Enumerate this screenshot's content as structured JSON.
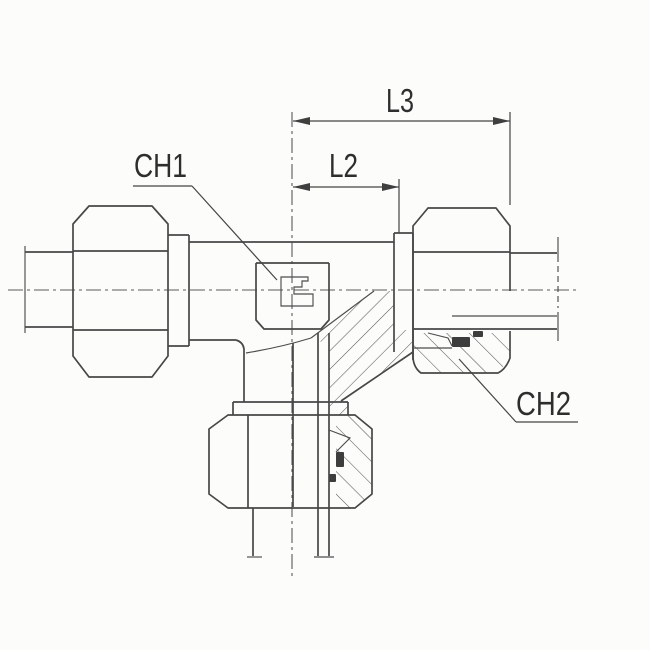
{
  "drawing": {
    "type": "technical-drawing-tee-fitting-half-section",
    "labels": {
      "l3": "L3",
      "l2": "L2",
      "ch1": "CH1",
      "ch2": "CH2"
    },
    "colors": {
      "background": "#fcfcfa",
      "line": "#474747",
      "text": "#2e2e2e",
      "section_fill": "#3d3d3d"
    }
  }
}
